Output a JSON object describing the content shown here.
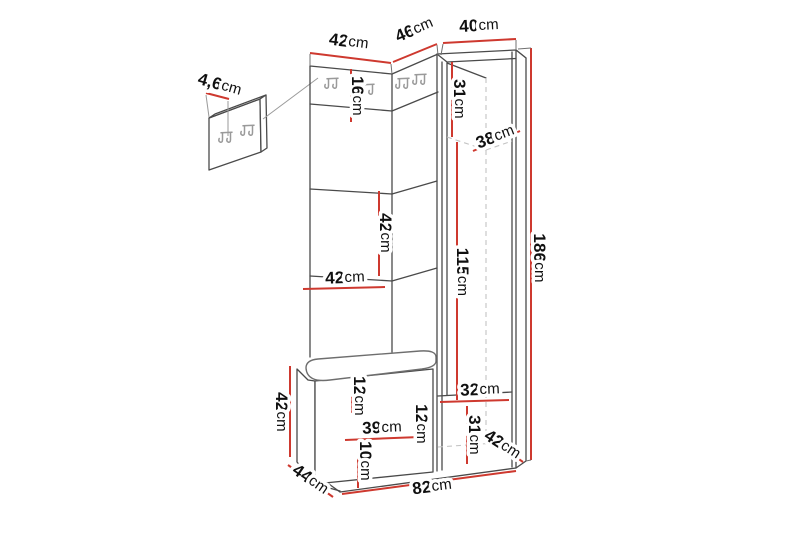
{
  "diagram": {
    "type": "furniture-dimension-diagram",
    "subject": "hallway unit with coat-hook panel, open shelves, bench seat and wardrobe cabinet",
    "unit": "cm",
    "colors": {
      "background": "#ffffff",
      "dimension_line": "#ce392f",
      "outline": "#4a4a4a",
      "hidden_line": "#c3c3c3",
      "hook": "#9a9a9a",
      "label_text": "#101010"
    },
    "dimensions": {
      "hook_panel_depth": {
        "value": "4,6",
        "unit": "cm"
      },
      "top_width_left": {
        "value": "42",
        "unit": "cm"
      },
      "top_width_middle": {
        "value": "46",
        "unit": "cm"
      },
      "top_width_right": {
        "value": "40",
        "unit": "cm"
      },
      "hook_strip_height": {
        "value": "16",
        "unit": "cm"
      },
      "cabinet_upper_section_height": {
        "value": "31",
        "unit": "cm"
      },
      "cabinet_shelf_diagonal": {
        "value": "38",
        "unit": "cm"
      },
      "shelf_spacing_height": {
        "value": "42",
        "unit": "cm"
      },
      "shelf_width": {
        "value": "42",
        "unit": "cm"
      },
      "open_section_height": {
        "value": "115",
        "unit": "cm"
      },
      "total_height": {
        "value": "186",
        "unit": "cm"
      },
      "bench_height": {
        "value": "42",
        "unit": "cm"
      },
      "bench_seat_inset_height": {
        "value": "12",
        "unit": "cm"
      },
      "bench_inner_width": {
        "value": "39",
        "unit": "cm"
      },
      "bench_inner_height": {
        "value": "12",
        "unit": "cm"
      },
      "bench_base_height": {
        "value": "10",
        "unit": "cm"
      },
      "cabinet_inner_width": {
        "value": "32",
        "unit": "cm"
      },
      "cabinet_lower_section_height": {
        "value": "31",
        "unit": "cm"
      },
      "cabinet_depth": {
        "value": "42",
        "unit": "cm"
      },
      "bench_depth": {
        "value": "44",
        "unit": "cm"
      },
      "total_width": {
        "value": "82",
        "unit": "cm"
      }
    }
  }
}
